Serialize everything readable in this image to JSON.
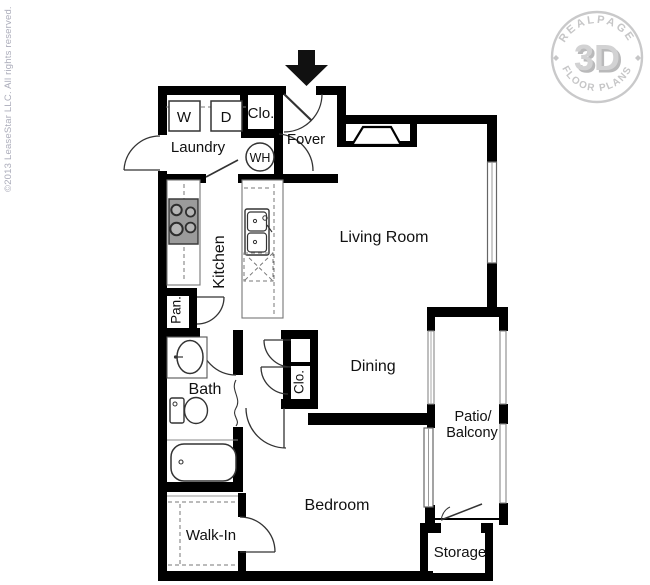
{
  "branding": {
    "copyright": "©2013 LeaseStar LLC. All rights reserved.",
    "logo": {
      "top": "REALPAGE",
      "center": "3D",
      "bottom": "FLOOR PLANS"
    }
  },
  "labels": {
    "living_room": "Living Room",
    "dining": "Dining",
    "bedroom": "Bedroom",
    "kitchen": "Kitchen",
    "laundry": "Laundry",
    "foyer": "Fover",
    "bath": "Bath",
    "walk_in": "Walk-In",
    "storage": "Storage",
    "patio_line1": "Patio/",
    "patio_line2": "Balcony",
    "pantry": "Pan.",
    "closet_foyer": "Clo.",
    "closet_hall": "Clo.",
    "water_heater": "WH",
    "washer": "W",
    "dryer": "D"
  }
}
